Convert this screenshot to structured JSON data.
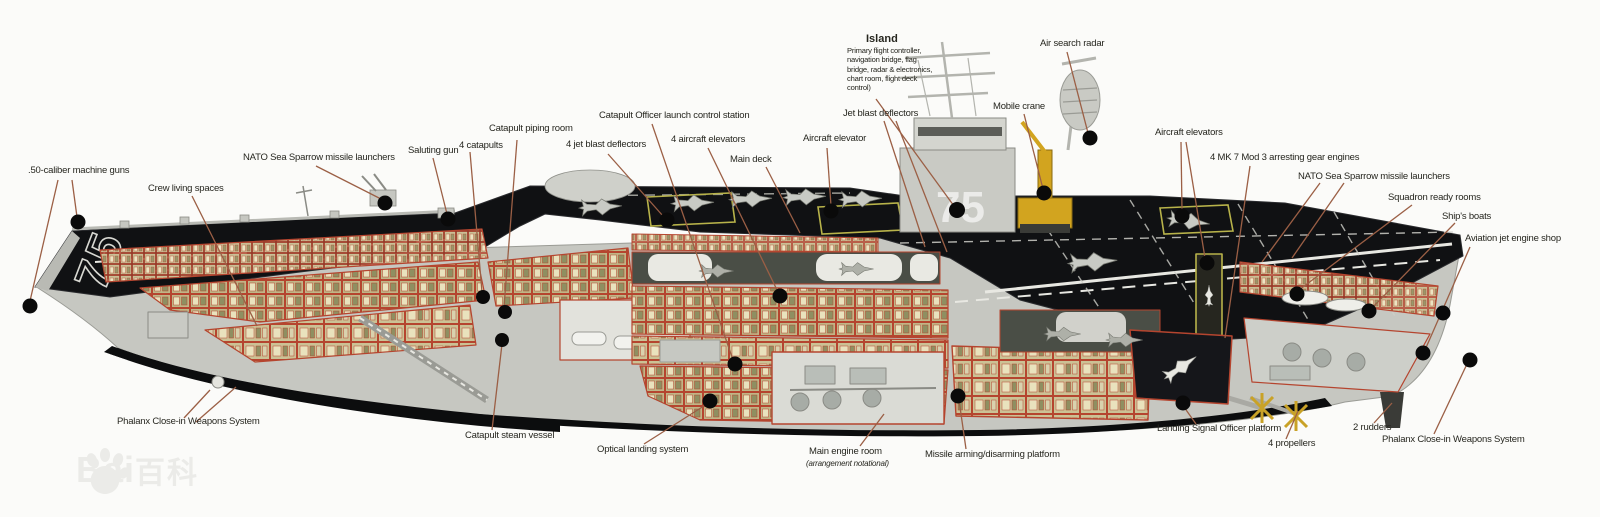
{
  "meta": {
    "title": "Aircraft carrier cutaway diagram (CVN-75 class)",
    "type": "annotated cutaway illustration"
  },
  "ship": {
    "hull_number_bow": "75",
    "hull_number_island": "75"
  },
  "colors": {
    "bg": "#fbfbf9",
    "text": "#26261f",
    "leader": "#9b5f45",
    "accent_red": "#b5452f",
    "deck_black": "#101113",
    "hull_gray": "#c6c7c1",
    "compartment_khaki": "#bfb687",
    "compartment_cream": "#e9e2bd",
    "compartment_olive": "#8f8f61",
    "crane_yellow": "#d2a41f",
    "elevator_outline_yellow": "#b8b34a",
    "watermark": "#ebebe8"
  },
  "labels": {
    "fifty_cal": {
      "text": ".50-caliber machine guns"
    },
    "crew_living": {
      "text": "Crew living spaces"
    },
    "nato_left": {
      "text": "NATO Sea Sparrow missile launchers"
    },
    "saluting_gun": {
      "text": "Saluting gun"
    },
    "catapults": {
      "text": "4 catapults"
    },
    "piping_room": {
      "text": "Catapult piping room"
    },
    "jbd_fwd": {
      "text": "4 jet blast deflectors"
    },
    "cat_officer": {
      "text": "Catapult Officer launch control station"
    },
    "elevators_fwd": {
      "text": "4 aircraft elevators"
    },
    "main_deck": {
      "text": "Main deck"
    },
    "aircraft_elevator": {
      "text": "Aircraft elevator"
    },
    "jbd_island": {
      "text": "Jet blast deflectors"
    },
    "island": {
      "text": "Island",
      "sub": "Primary flight controller,\nnavigation bridge, flag\nbridge, radar & electronics,\nchart room, flight deck\ncontrol)"
    },
    "air_radar": {
      "text": "Air search radar"
    },
    "mobile_crane": {
      "text": "Mobile crane"
    },
    "elevators_aft": {
      "text": "Aircraft elevators"
    },
    "arresting": {
      "text": "4 MK 7 Mod 3 arresting gear engines"
    },
    "nato_right": {
      "text": "NATO Sea Sparrow missile launchers"
    },
    "ready_rooms": {
      "text": "Squadron ready rooms"
    },
    "ships_boats": {
      "text": "Ship's boats"
    },
    "jet_shop": {
      "text": "Aviation jet engine shop"
    },
    "phalanx_left": {
      "text": "Phalanx Close-in Weapons System"
    },
    "steam_vessel": {
      "text": "Catapult steam vessel"
    },
    "optical_landing": {
      "text": "Optical landing system"
    },
    "engine_room": {
      "text": "Main engine room",
      "note": "(arrangement notational)"
    },
    "missile_platform": {
      "text": "Missile arming/disarming platform"
    },
    "lso_platform": {
      "text": "Landing Signal Officer platform"
    },
    "propellers": {
      "text": "4 propellers"
    },
    "rudders": {
      "text": "2 rudders"
    },
    "phalanx_right": {
      "text": "Phalanx Close-in Weapons System"
    }
  },
  "watermark": {
    "latin": "Bai",
    "cjk": "百科"
  }
}
